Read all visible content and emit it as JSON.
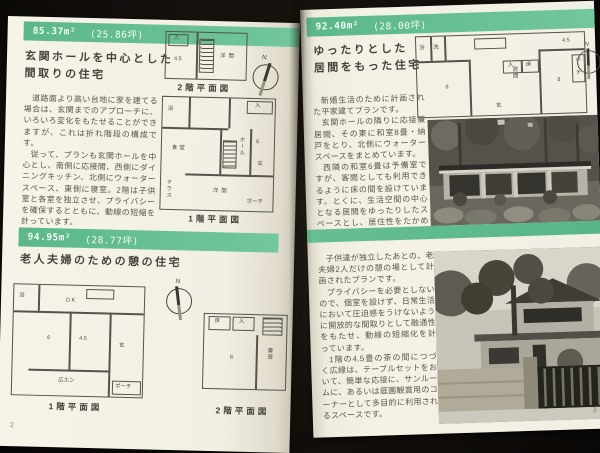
{
  "colors": {
    "band_green": "#5bb888",
    "page_cream": "#f3f0e5"
  },
  "left_page": {
    "page_number": "2",
    "top": {
      "area": "85.37m²",
      "tsubo": "(25.86坪)",
      "title1": "玄関ホールを中心とした",
      "title2": "間取りの住宅",
      "p": [
        "道路面より高い台地に家を建てる場合は、玄関までのアプローチに、いろいろ変化をもたせることができますが、これは折れ階段の構成です。",
        "従って、プランも玄関ホールを中心とし、南側に応接間、西側にダイニングキッチン、北側にウォータースペース、東側に寝室。2階は子供室と各室を独立させ、プライバシーを確保するとともに、動線の短縮を計っています。"
      ],
      "plan2f_label": "2階平面図",
      "plan1f_label": "1階平面図",
      "north": "N",
      "rooms2f": [
        "入",
        "4.5",
        "洋間"
      ],
      "rooms1f": [
        "浴",
        "入",
        "食堂",
        "6",
        "ホール",
        "玄",
        "洋間",
        "テラス",
        "ポーチ"
      ]
    },
    "bottom": {
      "area": "94.95m²",
      "tsubo": "(28.77坪)",
      "title": "老人夫婦のための憩の住宅",
      "plan1f_label": "1階平面図",
      "plan2f_label": "2階平面図",
      "north": "N",
      "rooms1f": [
        "浴",
        "D.K",
        "6",
        "4.5",
        "広エン",
        "玄",
        "ポーチ"
      ],
      "rooms2f": [
        "床",
        "入",
        "8",
        "書斎"
      ]
    }
  },
  "right_page": {
    "page_number": "3",
    "top": {
      "area": "92.40m²",
      "tsubo": "(28.00坪)",
      "title1": "ゆったりとした",
      "title2": "居間をもった住宅",
      "p": [
        "新婚生活のために計画された平家建てプランです。",
        "玄関ホールの隣りに応接兼居間、その東に和室8畳・納戸をとり、北側にウォータースペースをまとめています。",
        "西隣の和室6畳は予備室ですが、客間としても利用できるように床の間を設けています。とくに、生活空間の中心となる居間をゆったりしたスペースとし、居住性をたかめています。"
      ],
      "north": "N",
      "rooms": [
        "浴",
        "洗",
        "6",
        "居間",
        "8",
        "4.5",
        "入",
        "床",
        "玄",
        "ポーチ"
      ]
    },
    "bottom": {
      "p": [
        "子供達が独立したあとの、老夫婦2人だけの憩の場として計画されたプランです。",
        "プライバシーを必要としないので、個室を設けず、日常生活において圧迫感をうけないように開放的な間取りとして融通性をもたせ、動線の短縮化を計っています。",
        "1階の4.5畳の茶の間につづく広縁は、テーブルセットをおいて、簡単な応接に、サンルームに、あるいは庭園観賞用のコーナーとして多目的に利用されるスペースです。"
      ]
    }
  }
}
